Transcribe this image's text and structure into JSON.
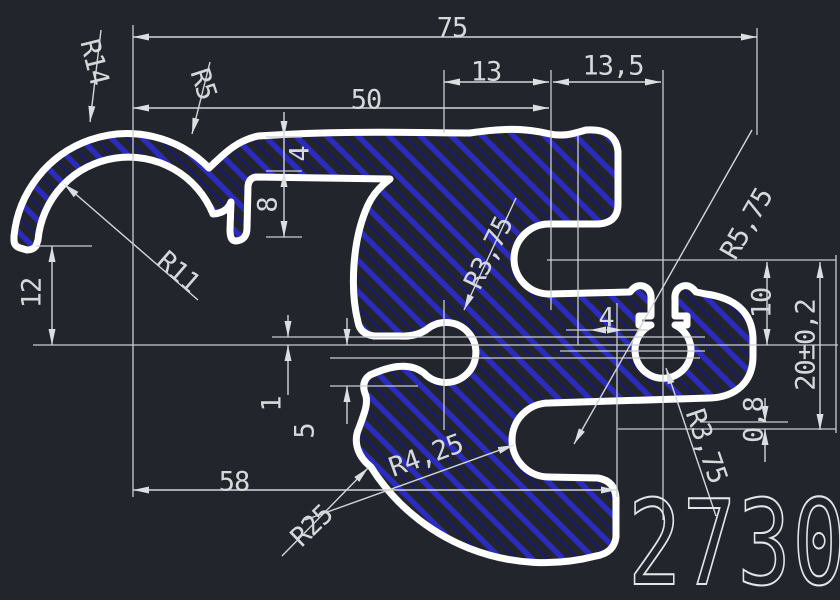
{
  "drawing": {
    "part_number": "2730",
    "linear_dimensions": [
      {
        "id": "width-overall",
        "label": "75",
        "orientation": "horizontal"
      },
      {
        "id": "width-50",
        "label": "50",
        "orientation": "horizontal"
      },
      {
        "id": "width-13",
        "label": "13",
        "orientation": "horizontal"
      },
      {
        "id": "width-13-5",
        "label": "13,5",
        "orientation": "horizontal"
      },
      {
        "id": "width-58",
        "label": "58",
        "orientation": "horizontal"
      },
      {
        "id": "height-12",
        "label": "12",
        "orientation": "vertical"
      },
      {
        "id": "flange-4",
        "label": "4",
        "orientation": "vertical"
      },
      {
        "id": "lip-8",
        "label": "8",
        "orientation": "vertical"
      },
      {
        "id": "slot-1",
        "label": "1",
        "orientation": "vertical"
      },
      {
        "id": "slot-5",
        "label": "5",
        "orientation": "vertical"
      },
      {
        "id": "ear-4",
        "label": "4",
        "orientation": "horizontal"
      },
      {
        "id": "height-10",
        "label": "10",
        "orientation": "vertical"
      },
      {
        "id": "height-20-tol",
        "label": "20±0,2",
        "orientation": "vertical"
      },
      {
        "id": "gap-0-8",
        "label": "0,8",
        "orientation": "vertical"
      }
    ],
    "radius_dimensions": [
      {
        "id": "r14",
        "label": "R14"
      },
      {
        "id": "r5",
        "label": "R5"
      },
      {
        "id": "r11",
        "label": "R11"
      },
      {
        "id": "r3-75-mid",
        "label": "R3,75"
      },
      {
        "id": "r5-75",
        "label": "R5,75"
      },
      {
        "id": "r25",
        "label": "R25"
      },
      {
        "id": "r4-25",
        "label": "R4,25"
      },
      {
        "id": "r3-75-right",
        "label": "R3,75"
      }
    ],
    "colors": {
      "background": "#22262c",
      "hatch_primary": "#2b2bc0",
      "hatch_secondary": "#17177e",
      "profile_outline": "#ffffff",
      "dimension_lines": "#c9ccd1",
      "text": "#d6d9dc"
    }
  }
}
